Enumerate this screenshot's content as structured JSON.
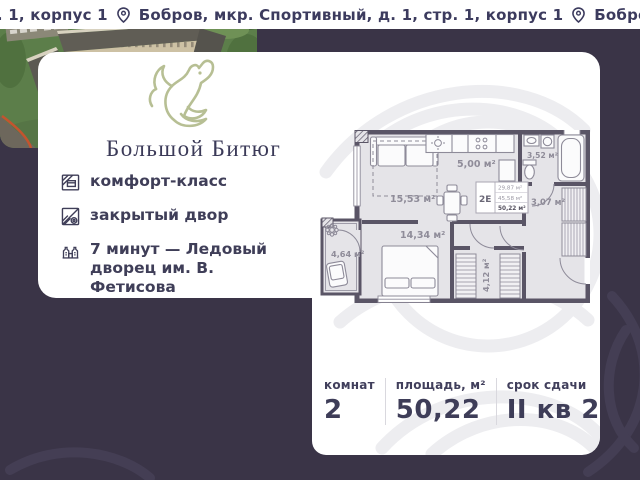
{
  "ticker": {
    "segment_1": "р. 1, корпус 1",
    "segment_2": "Бобров, мкр. Спортивный, д. 1, стр. 1, корпус 1",
    "segment_3": "Бобров, м"
  },
  "brand": {
    "name": "Большой Битюг",
    "logo_icon": "horse-logo"
  },
  "features": [
    {
      "icon": "comfort-class-icon",
      "label": "комфорт-класс"
    },
    {
      "icon": "closed-yard-icon",
      "label": "закрытый двор"
    },
    {
      "icon": "ice-palace-icon",
      "label": "7 минут — Ледовый дворец им. В. Фетисова"
    }
  ],
  "floor_plan": {
    "stamp": {
      "type": "2Е",
      "living_area": "29,87 м²",
      "area_without_balcony": "45,58 м²",
      "total_area": "50,22 м²"
    },
    "rooms": [
      {
        "name": "living-room",
        "area": "15,53 м²"
      },
      {
        "name": "kitchen",
        "area": "5,00 м²"
      },
      {
        "name": "bathroom",
        "area": "3,52 м²"
      },
      {
        "name": "hallway",
        "area": "3,07 м²"
      },
      {
        "name": "bedroom",
        "area": "14,34 м²"
      },
      {
        "name": "balcony",
        "area": "4,64 м²"
      },
      {
        "name": "closet",
        "area": "4,12 м²"
      }
    ]
  },
  "params": {
    "rooms_label": "комнат",
    "rooms_value": "2",
    "area_label": "площадь, м²",
    "area_value": "50,22",
    "deadline_label": "срок сдачи",
    "deadline_value": "II кв 2028"
  },
  "colors": {
    "background": "#3a3447",
    "navy_text": "#3c3b5e",
    "logo_green": "#b7bf94",
    "plan_walls": "#5a5566",
    "plan_floor": "#e5e4e8"
  }
}
